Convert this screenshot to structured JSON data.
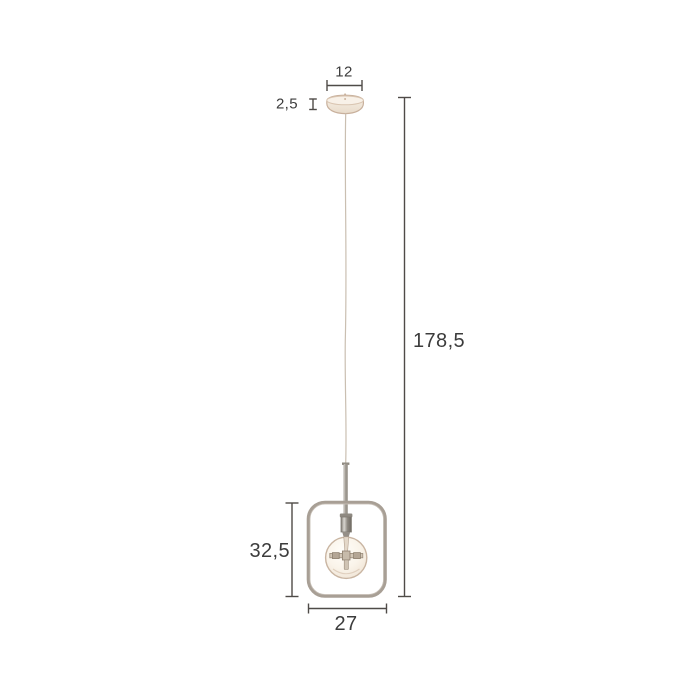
{
  "labels": {
    "canopy_width": "12",
    "canopy_height": "2,5",
    "total_height": "178,5",
    "frame_height": "32,5",
    "frame_width": "27"
  },
  "colors": {
    "background": "#ffffff",
    "dimension_line": "#4f4b48",
    "label_text": "#3c3c3c",
    "frame": "#a89f95",
    "metal": "#8e8981",
    "canopy_outline": "#c8b09c",
    "canopy_fill": "#f3eadf",
    "bulb_outline": "#c9b5a2",
    "bulb_fill": "#faf4ec",
    "cable": "#cabfb1"
  }
}
